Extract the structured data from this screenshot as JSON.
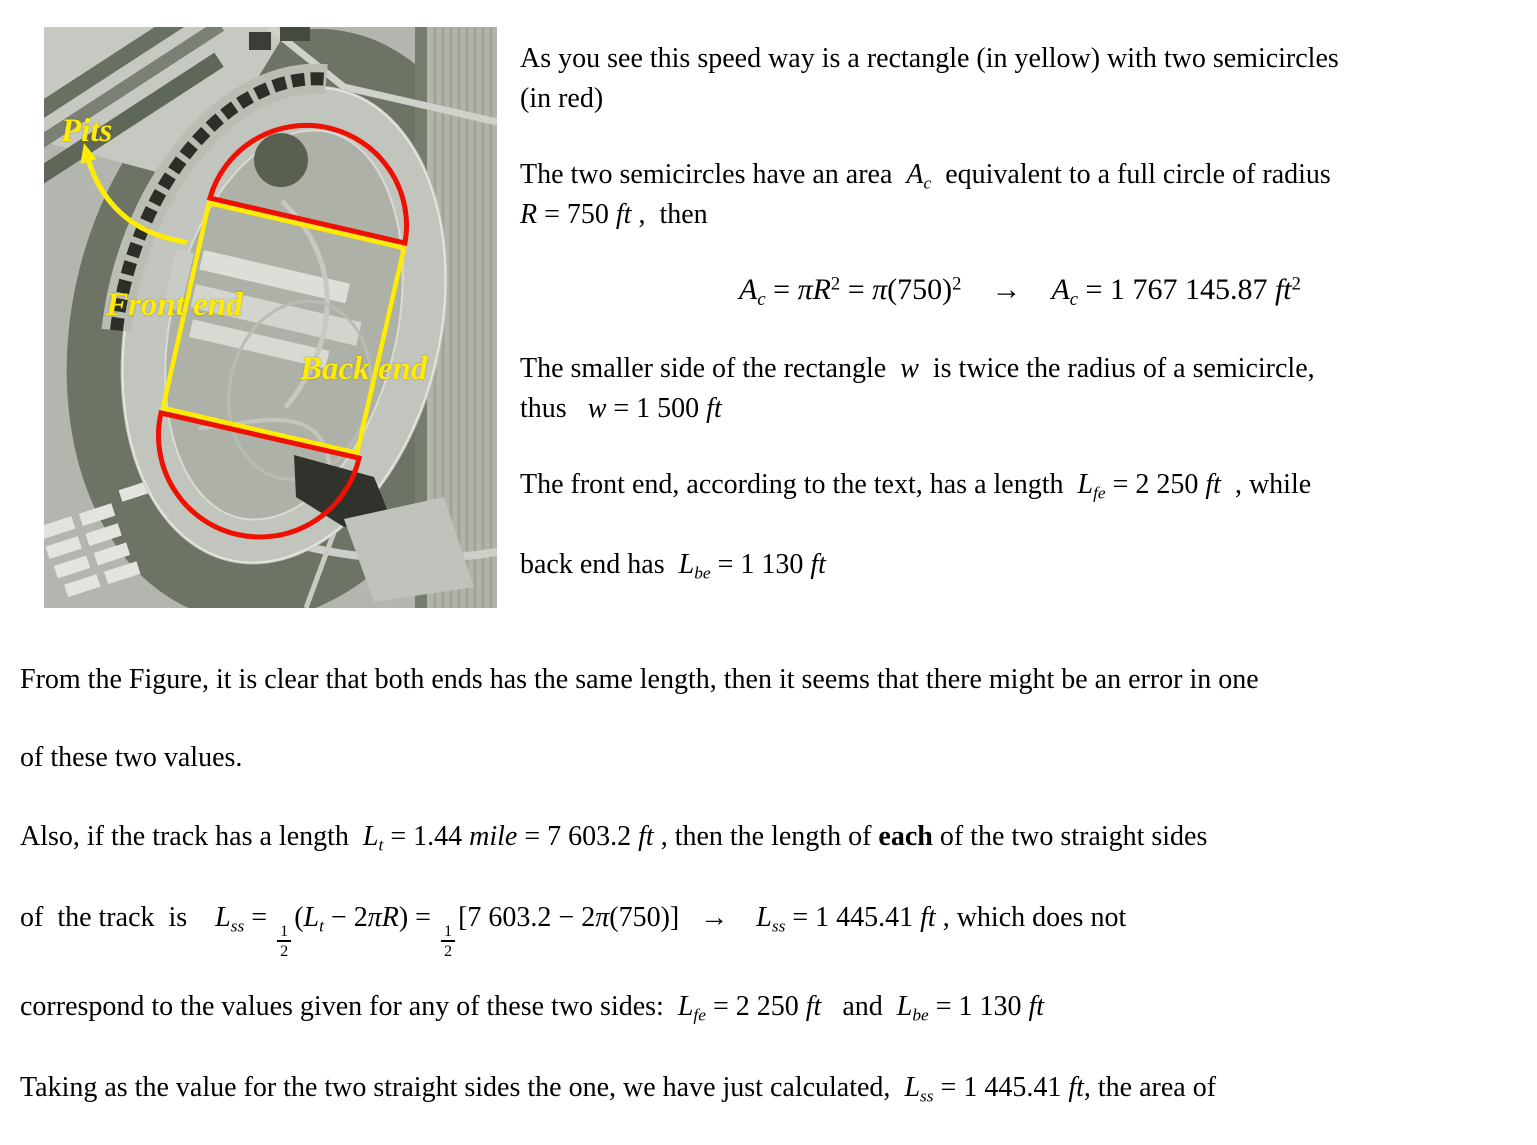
{
  "document": {
    "figure": {
      "labels": {
        "pits": "Pits",
        "front_end": "Front end",
        "back_end": "Back end"
      },
      "colors": {
        "annotation_yellow": "#ffec00",
        "annotation_red": "#ee1000"
      }
    },
    "right_column": {
      "l1": [
        {
          "t": "r",
          "s": "As you see this speed way is a rectangle (in yellow) with two semicircles"
        }
      ],
      "l2": [
        {
          "t": "r",
          "s": "(in red)"
        }
      ],
      "l3": [
        {
          "t": "r",
          "s": "The two semicircles have an area  "
        },
        {
          "t": "i",
          "s": "A"
        },
        {
          "t": "sub",
          "s": "c"
        },
        {
          "t": "r",
          "s": "  equivalent to a full circle of radius"
        }
      ],
      "l4": [
        {
          "t": "i",
          "s": "R"
        },
        {
          "t": "r",
          "s": " = 750 "
        },
        {
          "t": "i",
          "s": "ft"
        },
        {
          "t": "r",
          "s": " ,  then"
        }
      ],
      "eq": [
        {
          "t": "i",
          "s": "A"
        },
        {
          "t": "sub",
          "s": "c"
        },
        {
          "t": "r",
          "s": " = "
        },
        {
          "t": "i",
          "s": "πR"
        },
        {
          "t": "sup",
          "s": "2"
        },
        {
          "t": "r",
          "s": " = "
        },
        {
          "t": "i",
          "s": "π"
        },
        {
          "t": "r",
          "s": "(750)"
        },
        {
          "t": "sup",
          "s": "2"
        },
        {
          "t": "r",
          "s": "    →    "
        },
        {
          "t": "i",
          "s": "A"
        },
        {
          "t": "sub",
          "s": "c"
        },
        {
          "t": "r",
          "s": " = 1 767 145.87 "
        },
        {
          "t": "i",
          "s": "ft"
        },
        {
          "t": "sup",
          "s": "2"
        }
      ],
      "l5": [
        {
          "t": "r",
          "s": "The smaller side of the rectangle  "
        },
        {
          "t": "i",
          "s": "w"
        },
        {
          "t": "r",
          "s": "  is twice the radius of a semicircle,"
        }
      ],
      "l6": [
        {
          "t": "r",
          "s": "thus   "
        },
        {
          "t": "i",
          "s": "w"
        },
        {
          "t": "r",
          "s": " = 1 500 "
        },
        {
          "t": "i",
          "s": "ft"
        }
      ],
      "l7": [
        {
          "t": "r",
          "s": "The front end, according to the text, has a length  "
        },
        {
          "t": "i",
          "s": "L"
        },
        {
          "t": "sub",
          "s": "fe"
        },
        {
          "t": "r",
          "s": " = 2 250 "
        },
        {
          "t": "i",
          "s": "ft"
        },
        {
          "t": "r",
          "s": "  , while"
        }
      ],
      "l8": [
        {
          "t": "r",
          "s": "back end has  "
        },
        {
          "t": "i",
          "s": "L"
        },
        {
          "t": "sub",
          "s": "be"
        },
        {
          "t": "r",
          "s": " = 1 130 "
        },
        {
          "t": "i",
          "s": "ft"
        }
      ]
    },
    "bottom": {
      "b1": [
        {
          "t": "r",
          "s": "From the Figure, it is clear that both ends has the same length, then it seems that there might be an error in one"
        }
      ],
      "b2": [
        {
          "t": "r",
          "s": "of these two values."
        }
      ],
      "b3": [
        {
          "t": "r",
          "s": "Also, if the track has a length  "
        },
        {
          "t": "i",
          "s": "L"
        },
        {
          "t": "sub",
          "s": "t"
        },
        {
          "t": "r",
          "s": " = 1.44 "
        },
        {
          "t": "i",
          "s": "mile"
        },
        {
          "t": "r",
          "s": " = 7 603.2 "
        },
        {
          "t": "i",
          "s": "ft"
        },
        {
          "t": "r",
          "s": " , then the length of "
        },
        {
          "t": "b",
          "s": "each"
        },
        {
          "t": "r",
          "s": " of the two straight sides"
        }
      ],
      "b4": [
        {
          "t": "r",
          "s": "of  the track  is    "
        },
        {
          "t": "i",
          "s": "L"
        },
        {
          "t": "sub",
          "s": "ss"
        },
        {
          "t": "r",
          "s": " = "
        },
        {
          "t": "f",
          "s": "1/2"
        },
        {
          "t": "r",
          "s": "("
        },
        {
          "t": "i",
          "s": "L"
        },
        {
          "t": "sub",
          "s": "t"
        },
        {
          "t": "r",
          "s": " − 2"
        },
        {
          "t": "i",
          "s": "πR"
        },
        {
          "t": "r",
          "s": ") = "
        },
        {
          "t": "f",
          "s": "1/2"
        },
        {
          "t": "r",
          "s": "[7 603.2 − 2"
        },
        {
          "t": "i",
          "s": "π"
        },
        {
          "t": "r",
          "s": "(750)]   →    "
        },
        {
          "t": "i",
          "s": "L"
        },
        {
          "t": "sub",
          "s": "ss"
        },
        {
          "t": "r",
          "s": " = 1 445.41 "
        },
        {
          "t": "i",
          "s": "ft"
        },
        {
          "t": "r",
          "s": " , which does not"
        }
      ],
      "b5": [
        {
          "t": "r",
          "s": "correspond to the values given for any of these two sides:  "
        },
        {
          "t": "i",
          "s": "L"
        },
        {
          "t": "sub",
          "s": "fe"
        },
        {
          "t": "r",
          "s": " = 2 250 "
        },
        {
          "t": "i",
          "s": "ft"
        },
        {
          "t": "r",
          "s": "   and  "
        },
        {
          "t": "i",
          "s": "L"
        },
        {
          "t": "sub",
          "s": "be"
        },
        {
          "t": "r",
          "s": " = 1 130 "
        },
        {
          "t": "i",
          "s": "ft"
        }
      ],
      "b6": [
        {
          "t": "r",
          "s": "Taking as the value for the two straight sides the one, we have just calculated,  "
        },
        {
          "t": "i",
          "s": "L"
        },
        {
          "t": "sub",
          "s": "ss"
        },
        {
          "t": "r",
          "s": " = 1 445.41 "
        },
        {
          "t": "i",
          "s": "ft"
        },
        {
          "t": "r",
          "s": ", the area of"
        }
      ]
    }
  }
}
